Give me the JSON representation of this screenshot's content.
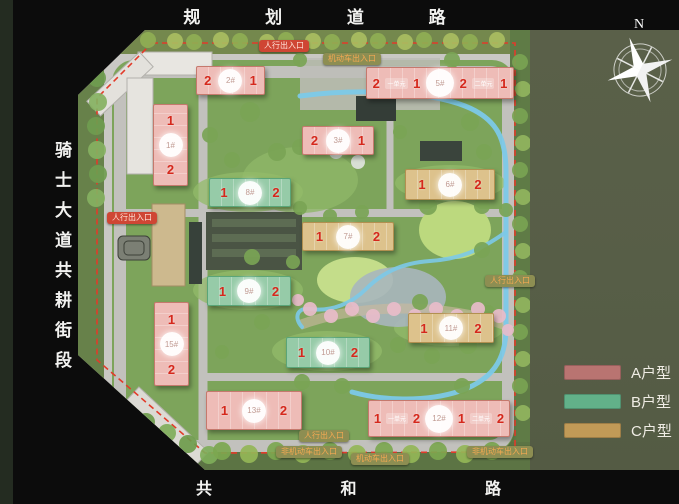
{
  "frame": {
    "top_road": "规 划 道 路",
    "left_road": "骑士大道共耕街段",
    "bottom_road": "共 和 路",
    "compass_label": "N"
  },
  "legend": {
    "items": [
      {
        "label": "A户型",
        "color": "#b97471"
      },
      {
        "label": "B户型",
        "color": "#62b189"
      },
      {
        "label": "C户型",
        "color": "#c19a57"
      }
    ]
  },
  "type_styles": {
    "A": {
      "fill": "#eebcb7",
      "border": "#c5796d"
    },
    "B": {
      "fill": "#96cba8",
      "border": "#5aa578"
    },
    "C": {
      "fill": "#ddc28c",
      "border": "#b29050"
    }
  },
  "badge_styles": {
    "red": {
      "bg": "#cf4634",
      "text": "#ffe3d8"
    },
    "olive": {
      "bg": "#8d8e52",
      "text": "#f4a952"
    }
  },
  "buildings": [
    {
      "id": "1#",
      "name": "building-1",
      "type": "A",
      "x": 153,
      "y": 104,
      "w": 33,
      "h": 74,
      "vertical": true,
      "cells": [
        {
          "k": "n",
          "v": "1"
        },
        {
          "k": "c",
          "v": "1#"
        },
        {
          "k": "n",
          "v": "2"
        }
      ]
    },
    {
      "id": "2#",
      "name": "building-2",
      "type": "A",
      "x": 196,
      "y": 66,
      "w": 67,
      "h": 27,
      "cells": [
        {
          "k": "n",
          "v": "2"
        },
        {
          "k": "c",
          "v": "2#"
        },
        {
          "k": "n",
          "v": "1"
        }
      ]
    },
    {
      "id": "3#",
      "name": "building-3",
      "type": "A",
      "x": 302,
      "y": 126,
      "w": 70,
      "h": 27,
      "cells": [
        {
          "k": "n",
          "v": "2"
        },
        {
          "k": "c",
          "v": "3#"
        },
        {
          "k": "n",
          "v": "1"
        }
      ]
    },
    {
      "id": "5#",
      "name": "building-5",
      "type": "A",
      "x": 366,
      "y": 67,
      "w": 146,
      "h": 30,
      "big": true,
      "cells": [
        {
          "k": "n",
          "v": "2"
        },
        {
          "k": "u",
          "v": "一单元"
        },
        {
          "k": "n",
          "v": "1"
        },
        {
          "k": "c",
          "v": "5#"
        },
        {
          "k": "n",
          "v": "2"
        },
        {
          "k": "u",
          "v": "二单元"
        },
        {
          "k": "n",
          "v": "1"
        }
      ]
    },
    {
      "id": "6#",
      "name": "building-6",
      "type": "C",
      "x": 405,
      "y": 169,
      "w": 88,
      "h": 29,
      "cells": [
        {
          "k": "n",
          "v": "1"
        },
        {
          "k": "c",
          "v": "6#"
        },
        {
          "k": "n",
          "v": "2"
        }
      ]
    },
    {
      "id": "7#",
      "name": "building-7",
      "type": "C",
      "x": 302,
      "y": 222,
      "w": 90,
      "h": 27,
      "cells": [
        {
          "k": "n",
          "v": "1"
        },
        {
          "k": "c",
          "v": "7#"
        },
        {
          "k": "n",
          "v": "2"
        }
      ]
    },
    {
      "id": "8#",
      "name": "building-8",
      "type": "B",
      "x": 209,
      "y": 178,
      "w": 80,
      "h": 27,
      "cells": [
        {
          "k": "n",
          "v": "1"
        },
        {
          "k": "c",
          "v": "8#"
        },
        {
          "k": "n",
          "v": "2"
        }
      ]
    },
    {
      "id": "9#",
      "name": "building-9",
      "type": "B",
      "x": 207,
      "y": 276,
      "w": 82,
      "h": 28,
      "cells": [
        {
          "k": "n",
          "v": "1"
        },
        {
          "k": "c",
          "v": "9#"
        },
        {
          "k": "n",
          "v": "2"
        }
      ]
    },
    {
      "id": "10#",
      "name": "building-10",
      "type": "B",
      "x": 286,
      "y": 337,
      "w": 82,
      "h": 29,
      "cells": [
        {
          "k": "n",
          "v": "1"
        },
        {
          "k": "c",
          "v": "10#"
        },
        {
          "k": "n",
          "v": "2"
        }
      ]
    },
    {
      "id": "11#",
      "name": "building-11",
      "type": "C",
      "x": 408,
      "y": 313,
      "w": 84,
      "h": 28,
      "cells": [
        {
          "k": "n",
          "v": "1"
        },
        {
          "k": "c",
          "v": "11#"
        },
        {
          "k": "n",
          "v": "2"
        }
      ]
    },
    {
      "id": "12#",
      "name": "building-12",
      "type": "A",
      "x": 368,
      "y": 400,
      "w": 140,
      "h": 35,
      "big": true,
      "cells": [
        {
          "k": "n",
          "v": "1"
        },
        {
          "k": "u",
          "v": "一单元"
        },
        {
          "k": "n",
          "v": "2"
        },
        {
          "k": "c",
          "v": "12#"
        },
        {
          "k": "n",
          "v": "1"
        },
        {
          "k": "u",
          "v": "二单元"
        },
        {
          "k": "n",
          "v": "2"
        }
      ]
    },
    {
      "id": "13#",
      "name": "building-13",
      "type": "A",
      "x": 206,
      "y": 391,
      "w": 94,
      "h": 37,
      "cells": [
        {
          "k": "n",
          "v": "1"
        },
        {
          "k": "c",
          "v": "13#"
        },
        {
          "k": "n",
          "v": "2"
        }
      ]
    },
    {
      "id": "15#",
      "name": "building-15",
      "type": "A",
      "x": 154,
      "y": 302,
      "w": 33,
      "h": 76,
      "vertical": true,
      "cells": [
        {
          "k": "n",
          "v": "1"
        },
        {
          "k": "c",
          "v": "15#"
        },
        {
          "k": "n",
          "v": "2"
        }
      ]
    }
  ],
  "entrances": [
    {
      "name": "pedestrian-entrance-north",
      "label": "人行出入口",
      "style": "red",
      "x": 284,
      "y": 46
    },
    {
      "name": "vehicle-entrance-north",
      "label": "机动车出入口",
      "style": "olive",
      "x": 352,
      "y": 59
    },
    {
      "name": "pedestrian-entrance-west",
      "label": "人行出入口",
      "style": "red",
      "x": 132,
      "y": 218
    },
    {
      "name": "pedestrian-entrance-east",
      "label": "人行出入口",
      "style": "olive",
      "x": 510,
      "y": 281
    },
    {
      "name": "pedestrian-entrance-south",
      "label": "人行出入口",
      "style": "olive",
      "x": 324,
      "y": 436
    },
    {
      "name": "non-motor-entrance-south",
      "label": "非机动车出入口",
      "style": "olive",
      "x": 309,
      "y": 452
    },
    {
      "name": "vehicle-entrance-south",
      "label": "机动车出入口",
      "style": "olive",
      "x": 380,
      "y": 459
    },
    {
      "name": "non-motor-entrance-southeast",
      "label": "非机动车出入口",
      "style": "olive",
      "x": 500,
      "y": 452
    }
  ]
}
